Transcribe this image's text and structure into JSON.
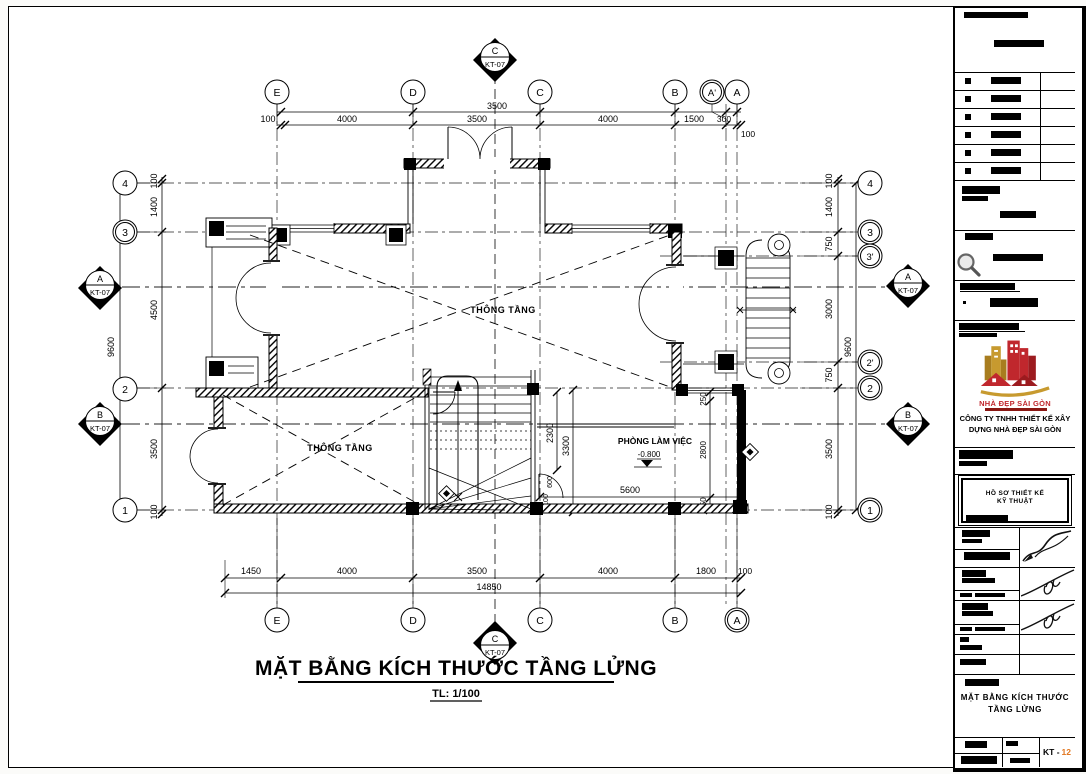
{
  "drawing": {
    "title": "MẶT BẰNG KÍCH THƯỚC TẦNG LỬNG",
    "scale": "TL: 1/100",
    "labels": {
      "void_upper": "THÔNG TẦNG",
      "void_lower": "THÔNG TẦNG",
      "office": "PHÒNG LÀM VIỆC",
      "office_level": "-0.800"
    },
    "grid": {
      "top": [
        "E",
        "D",
        "C",
        "B",
        "A'",
        "A"
      ],
      "bottom": [
        "E",
        "D",
        "C",
        "B",
        "A"
      ],
      "left": [
        "4",
        "3",
        "2",
        "1"
      ],
      "right": [
        "4",
        "3",
        "3'",
        "2'",
        "2",
        "1"
      ]
    },
    "sections": {
      "a": "A",
      "b": "B",
      "c": "C",
      "ref": "KT-07"
    },
    "dims": {
      "top_sub": "3500",
      "top": [
        "100",
        "4000",
        "3500",
        "4000",
        "1500",
        "300"
      ],
      "top_right_extra": "100",
      "bottom": [
        "1450",
        "4000",
        "3500",
        "4000",
        "1800",
        "100"
      ],
      "bottom_total": "14850",
      "left": [
        "100",
        "1400",
        "4500",
        "3500",
        "100"
      ],
      "left_total": "9600",
      "right": [
        "100",
        "1400",
        "750",
        "3000",
        "750",
        "3500",
        "100"
      ],
      "right_total": "9600",
      "room": [
        "2300",
        "3300",
        "5600",
        "250",
        "2800",
        "250",
        "600",
        "100"
      ]
    }
  },
  "title_block": {
    "logo_text": "NHÀ ĐẸP SÀI GÒN",
    "company_line1": "CÔNG TY TNHH THIẾT KẾ XÂY",
    "company_line2": "DỰNG NHÀ ĐẸP SÀI GÒN",
    "doc_box_line1": "HỒ SƠ THIẾT KẾ",
    "doc_box_line2": "KỸ THUẬT",
    "sheet_title_line1": "MẶT BẰNG KÍCH THƯỚC",
    "sheet_title_line2": "TẦNG LỬNG",
    "sheet_code_prefix": "KT -",
    "sheet_code_number": "12"
  },
  "colors": {
    "line": "#000000",
    "sheet_no_orange": "#e1761f",
    "logo_red": "#c0272d",
    "logo_gold": "#c79a2f"
  }
}
